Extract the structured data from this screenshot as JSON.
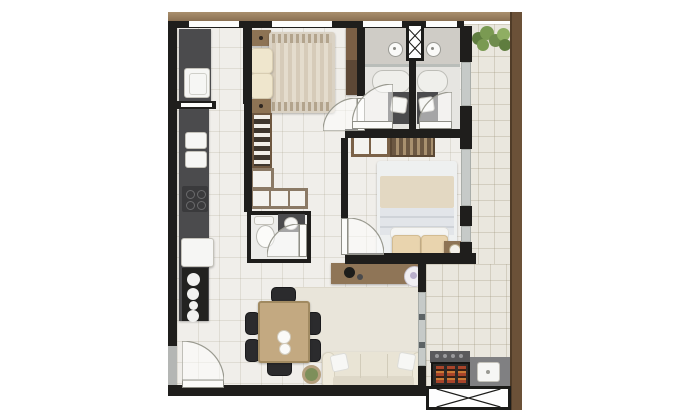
{
  "scene": {
    "type": "apartment-floor-plan-3d-render",
    "view": "top-down",
    "rooms": [
      {
        "name": "service-area",
        "items": [
          "dark-counter",
          "laundry-sink",
          "window"
        ]
      },
      {
        "name": "kitchen",
        "items": [
          "dark-counter",
          "double-sink",
          "cooktop",
          "refrigerator",
          "stove-4-burners",
          "pass-through"
        ]
      },
      {
        "name": "bedroom-1",
        "items": [
          "double-bed-striped-duvet",
          "two-cream-pillows",
          "two-nightstands",
          "tall-wardrobe",
          "window",
          "door"
        ]
      },
      {
        "name": "closet",
        "items": [
          "striped-shelf-unit",
          "white-door-cabinets-l-shape"
        ]
      },
      {
        "name": "wc-lavatory",
        "items": [
          "toilet",
          "vanity-washbasin",
          "door"
        ]
      },
      {
        "name": "bathroom-1",
        "items": [
          "shower-head",
          "bathtub-pill",
          "dark-vanity",
          "washbasin",
          "window",
          "door"
        ]
      },
      {
        "name": "bathroom-2",
        "items": [
          "shower-head",
          "bathtub-pill",
          "dark-vanity",
          "washbasin",
          "window",
          "door"
        ]
      },
      {
        "name": "duct-shaft",
        "items": [
          "x-hatched-box"
        ]
      },
      {
        "name": "bedroom-2",
        "items": [
          "double-bed-white-duvet",
          "two-tan-pillows",
          "wardrobe-cabinet",
          "hanging-clothes-rail",
          "nightstand-with-lamp",
          "glazed-wall",
          "door"
        ]
      },
      {
        "name": "living-dining",
        "items": [
          "dining-table",
          "six-black-chairs",
          "two-plates",
          "rug",
          "cream-sofa",
          "two-white-cushions",
          "tv-sideboard",
          "round-decor",
          "plant-pot",
          "entry-door"
        ]
      },
      {
        "name": "balcony",
        "items": [
          "planter-hedge",
          "barbecue-grill-coals",
          "grey-counter-sink",
          "x-hatched-bench",
          "sliding-glass-door",
          "wood-perimeter-wall"
        ]
      }
    ],
    "counts": {
      "bedrooms": 2,
      "bathrooms": 2,
      "dining_chairs": 6,
      "stove_burners": 4
    }
  },
  "colors": {
    "wall": "#1f1e1c",
    "wood_band": "#8a7052",
    "wood_wall": "#6b5138",
    "floor": "#f0eeea",
    "balcony": "#eae7de",
    "bath": "#e6e5e1",
    "shower": "#cfccc6",
    "counter": "#4b4b4d",
    "wood": "#8d7354",
    "wood_dark": "#6e5740",
    "wood_light": "#c3a981",
    "cream": "#e9e2d2",
    "pillow": "#efe6cd",
    "tan": "#e9d4ae",
    "white_fix": "#f6f6f4",
    "glass": "#c6cac8",
    "green": "#6f8c4d",
    "chair": "#2b2b2d",
    "rug": "#e9e5da",
    "sofa": "#e9e4d5",
    "coal": "#a8442a"
  }
}
